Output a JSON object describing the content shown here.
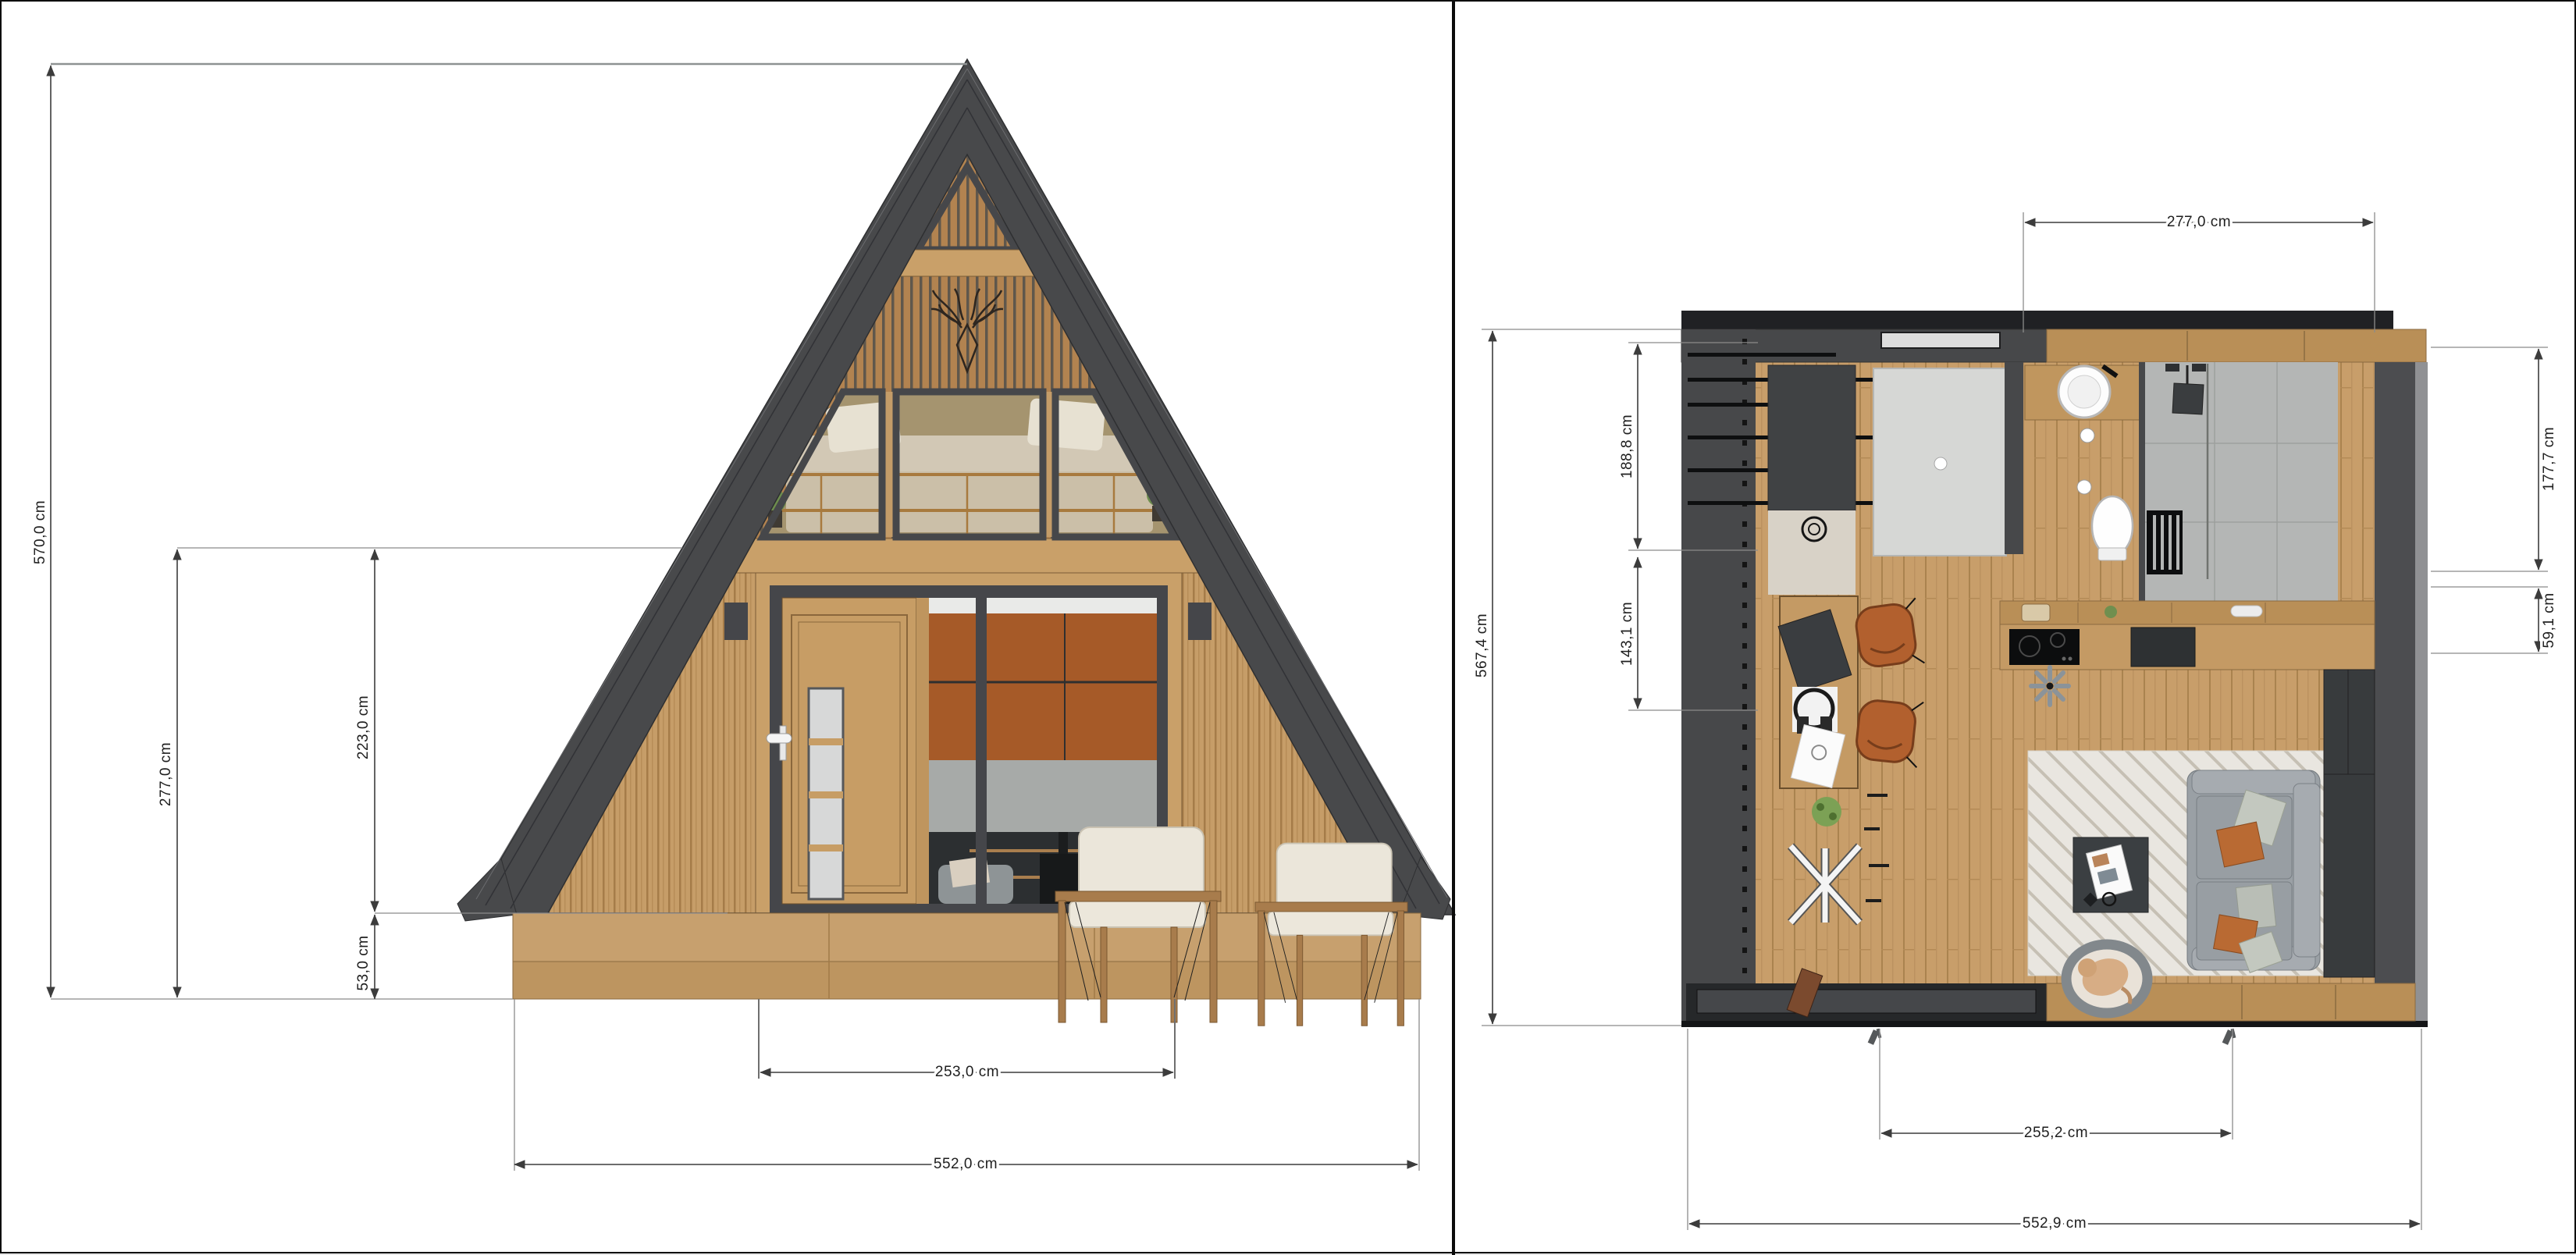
{
  "sheet": {
    "left_view": "front-elevation",
    "right_view": "floor-plan",
    "units": "cm"
  },
  "elevation": {
    "dims": {
      "total_height": "570,0 cm",
      "wall_height": "277,0 cm",
      "door_height": "223,0 cm",
      "deck_height": "53,0 cm",
      "door_width": "253,0 cm",
      "base_width": "552,0 cm"
    }
  },
  "floor_plan": {
    "dims": {
      "loft_width": "277,0 cm",
      "total_depth": "567,4 cm",
      "bedroom_zone_depth": "188,8 cm",
      "desk_zone_depth": "143,1 cm",
      "bathroom_depth": "177,7 cm",
      "counter_depth": "59,1 cm",
      "terrace_door_width": "255,2 cm",
      "total_width": "552,9 cm"
    }
  },
  "colors": {
    "roof": "#48494b",
    "wood_cladding": "#c69d68",
    "gable_slats": "#b28350",
    "orange_panels": "#a65a28",
    "glass_gray": "#a7aaa8",
    "plan_wall": "#47484a",
    "plan_floor": "#c89e6a",
    "bath_tile": "#b4b6b5",
    "bedroom_rug": "#d6d7d5",
    "living_rug": "#e9e6e0",
    "sofa": "#9aa0a5",
    "desk_chairs": "#b2602e"
  }
}
